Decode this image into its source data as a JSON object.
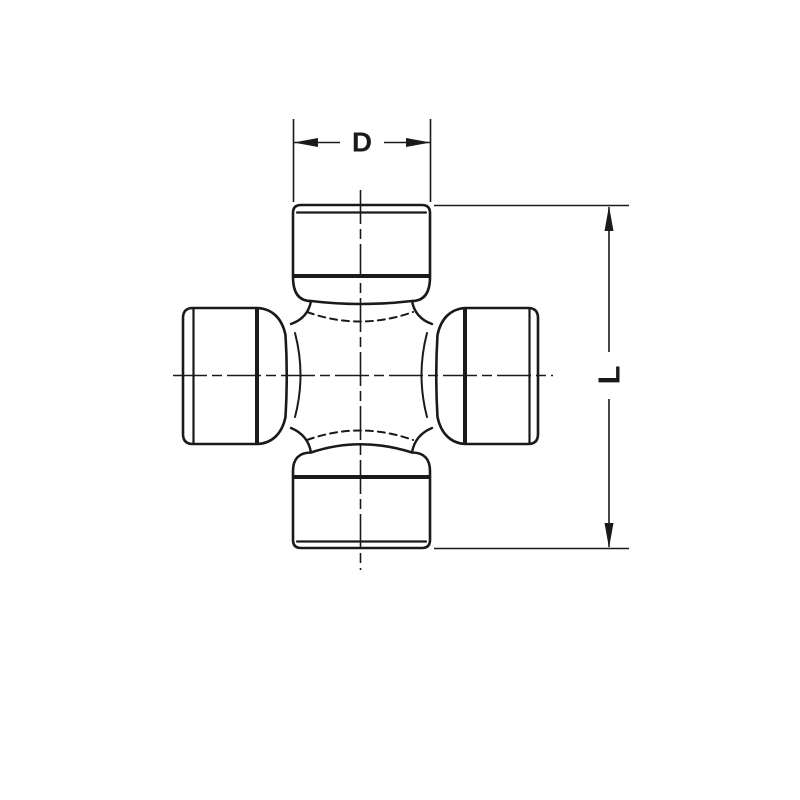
{
  "page": {
    "background_color": "#ffffff",
    "line_color": "#1a1a1a"
  },
  "drawing": {
    "subject": "universal-joint-cross-spider-technical-drawing",
    "style": "black line engineering diagram on white background",
    "labels": {
      "width_dimension": "D",
      "length_dimension": "L"
    }
  }
}
